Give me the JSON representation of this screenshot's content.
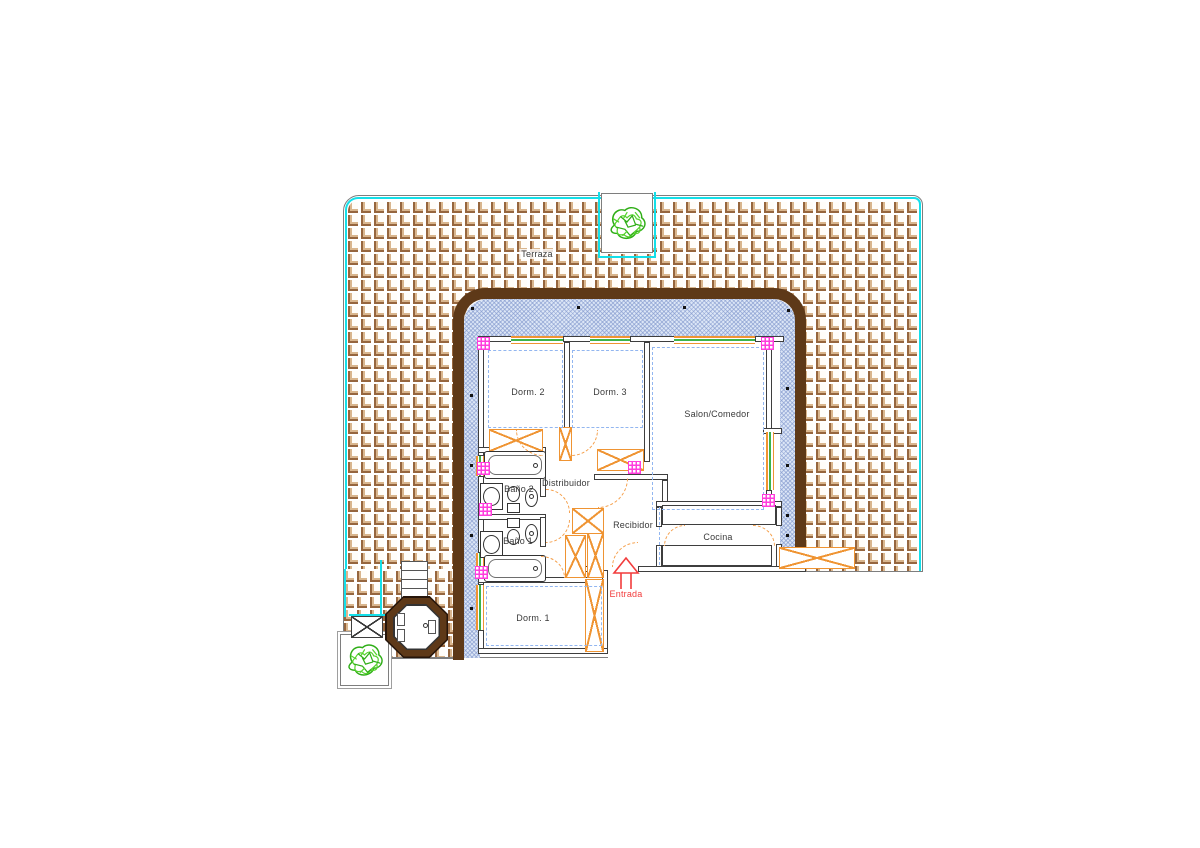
{
  "plan": {
    "title": "apartment floor plan with terrace",
    "rooms": {
      "terraza": {
        "label": "Terraza"
      },
      "dorm2": {
        "label": "Dorm. 2"
      },
      "dorm3": {
        "label": "Dorm. 3"
      },
      "salon": {
        "label": "Salon/Comedor"
      },
      "distribuidor": {
        "label": "Distribuidor"
      },
      "bano2": {
        "label": "Baño 2"
      },
      "bano1": {
        "label": "Baño 1"
      },
      "recibidor": {
        "label": "Recibidor"
      },
      "cocina": {
        "label": "Cocina"
      },
      "dorm1": {
        "label": "Dorm. 1"
      }
    },
    "entrance": {
      "label": "Entrada"
    },
    "colors": {
      "terrace_tile_brown": "#96663e",
      "terrace_tile_tan": "#d9b68e",
      "pool_edge_cyan": "#14dfe9",
      "building_wall_brown": "#5e3918",
      "insulation_blue_fill": "#dce6f6",
      "insulation_hatch_line": "#8298cd",
      "furniture_orange": "#ef9433",
      "window_green": "#3cb44a",
      "column_magenta": "#ff3ddd",
      "entrance_red": "#f23c3c",
      "interior_wall_gray": "#3e3e3e",
      "plant_green_dark": "#2fae17",
      "plant_green_light": "#56d32e"
    },
    "features": {
      "plant_top": "plant-icon",
      "plant_bottom_left": "plant-icon",
      "jacuzzi": "jacuzzi-octagon",
      "steps": "stair-steps",
      "bench": "bench-crossed",
      "entrance_arrow": "arrow-up-icon"
    }
  }
}
